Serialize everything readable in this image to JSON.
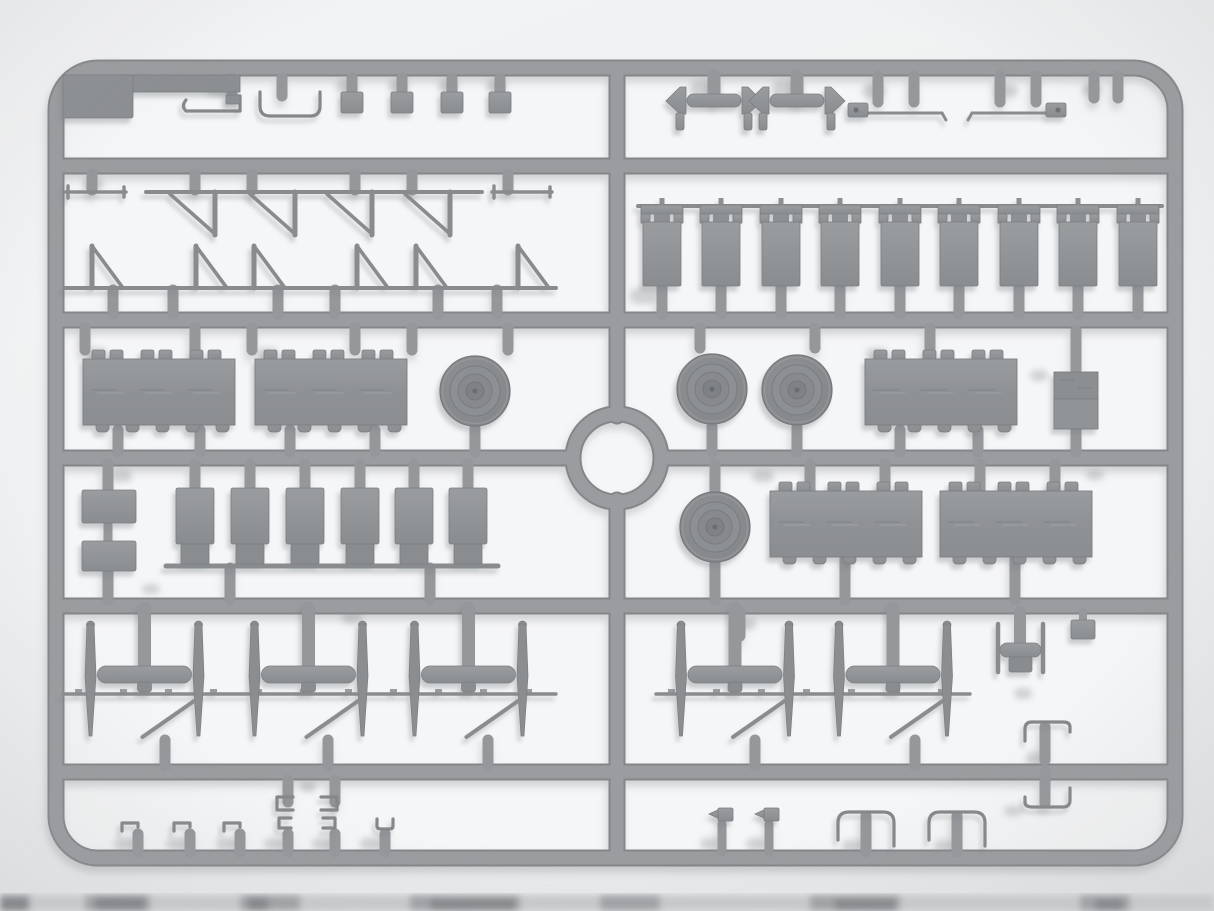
{
  "scene": {
    "description": "Photograph of a light-gray injection-molded plastic model kit sprue (runner frame) with vehicle parts, on a pale studio background; a blurred edge of a second sprue is visible at the bottom of the photo",
    "object_type": "model-kit-sprue-photo",
    "plastic_color_name": "light gray styrene"
  },
  "palette": {
    "background_top": "#f3f4f5",
    "background_bottom": "#e6e7e9",
    "cell_interior": "#f5f6f7",
    "runner_rail": "#9a9c9f",
    "runner_rail_shade": "#84868a",
    "part_fill": "#8f9295",
    "part_edge": "#7b7e81",
    "wheel_tire": "#85888b",
    "cast_shadow": "#b2b4b6",
    "bottom_strip": "#a0a2a5"
  },
  "inventory": {
    "frame": {
      "shape": "rounded rectangle",
      "horizontal_rails": 5,
      "central_vertical_rail": 1,
      "central_ring": 1
    },
    "row1_top": {
      "corner_plate": 1,
      "l_bracket": 1,
      "u_channel": 1,
      "square_posts": 4,
      "mirror_assemblies": 2,
      "wiper_arms": 2
    },
    "row2": {
      "tie_rods": 2,
      "v_truss_brackets": 4,
      "a_truss_brackets": 6,
      "hanging_panels": 9
    },
    "row3": {
      "track_pad_blocks": 3,
      "road_wheels": 3,
      "equipment_box": 1
    },
    "row4": {
      "mounting_plates": 2,
      "seats": 6,
      "road_wheels": 1,
      "track_pad_blocks": 2
    },
    "row5": {
      "axle_assemblies": 5,
      "steering_column": 1,
      "small_plate": 1,
      "corner_brackets": 2
    },
    "row6": {
      "j_clips": 3,
      "c_channel_clips": 4,
      "u_clip": 1,
      "pin_flag_parts": 2,
      "staple_handles": 2
    }
  },
  "counts_total": {
    "road_wheels": 4,
    "track_pad_blocks": 5,
    "hanging_panels": 9,
    "seats": 6,
    "axle_assemblies": 5
  }
}
